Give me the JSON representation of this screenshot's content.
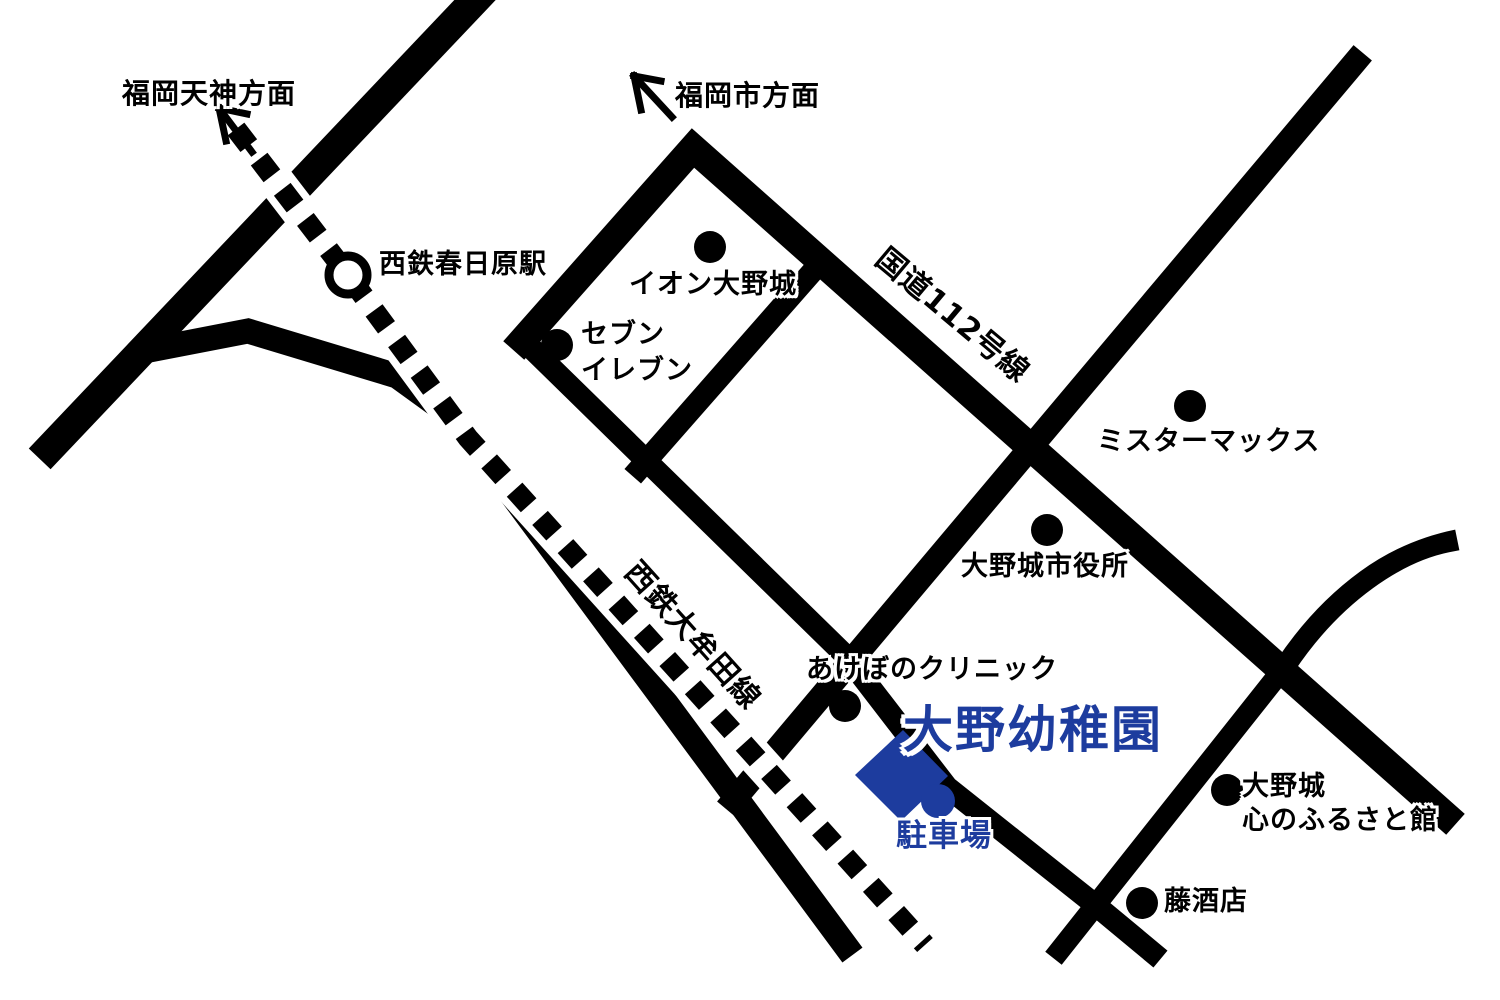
{
  "map": {
    "background": "#ffffff",
    "colors": {
      "road_black": "#000000",
      "accent_blue": "#1d3c9e",
      "halo_white": "#ffffff"
    },
    "destination": {
      "name": "大野幼稚園",
      "parking_label": "駐車場"
    },
    "directions": {
      "tenjin": "福岡天神方面",
      "fukuoka_city": "福岡市方面"
    },
    "railway": {
      "line_name": "西鉄大牟田線",
      "station_name": "西鉄春日原駅"
    },
    "route": {
      "name": "国道112号線"
    },
    "pois": [
      {
        "id": "aeon-onojo",
        "lines": [
          "イオン大野城"
        ]
      },
      {
        "id": "seven-eleven",
        "lines": [
          "セブン",
          "イレブン"
        ]
      },
      {
        "id": "mister-max",
        "lines": [
          "ミスターマックス"
        ]
      },
      {
        "id": "onojo-city-hall",
        "lines": [
          "大野城市役所"
        ]
      },
      {
        "id": "akebono-clinic",
        "lines": [
          "あけぼのクリニック"
        ]
      },
      {
        "id": "onojo-kokoro-furusato-kan",
        "lines": [
          "大野城",
          "心のふるさと館"
        ]
      },
      {
        "id": "fuji-sake-shop",
        "lines": [
          "藤酒店"
        ]
      }
    ]
  }
}
